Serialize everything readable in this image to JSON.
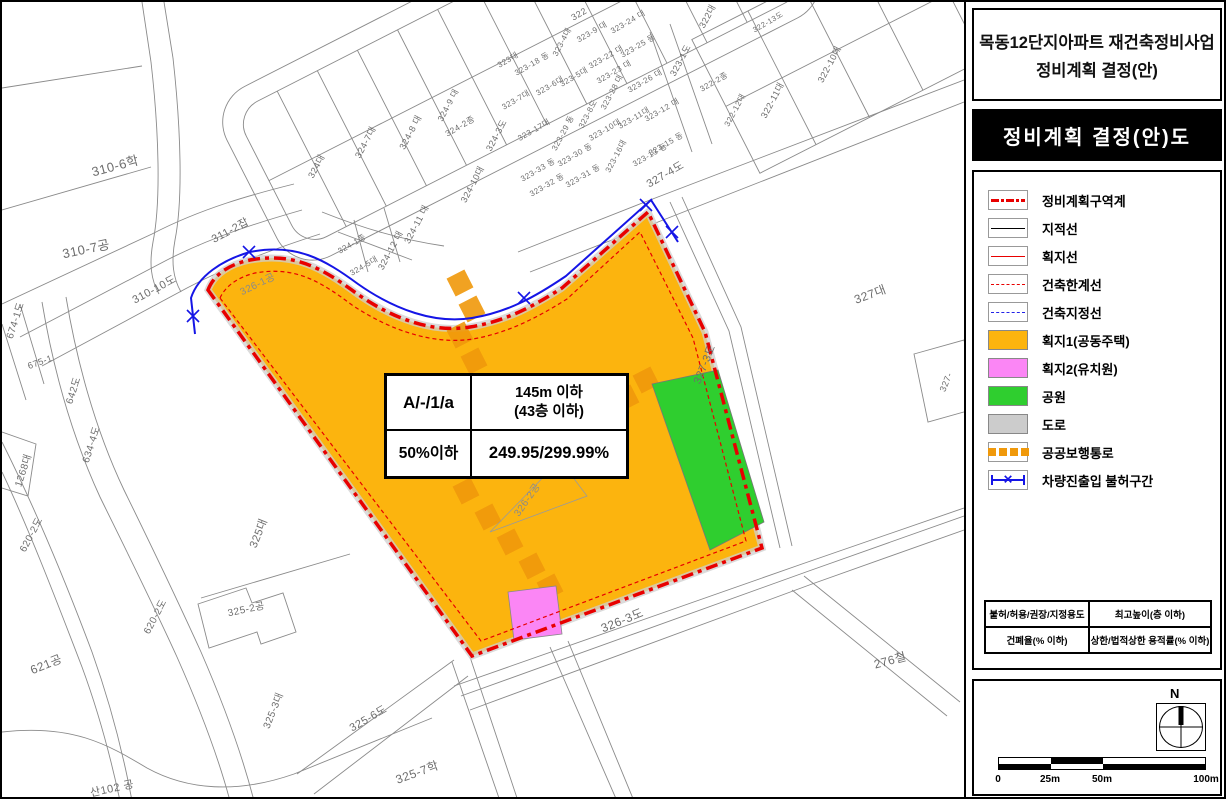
{
  "panel": {
    "title_line1": "목동12단지아파트 재건축정비사업",
    "title_line2": "정비계획 결정(안)",
    "subtitle": "정비계획 결정(안)도",
    "legend": {
      "items": [
        {
          "label": "정비계획구역계",
          "swatch": "red-dash-dot-line"
        },
        {
          "label": "지적선",
          "swatch": "black-line"
        },
        {
          "label": "획지선",
          "swatch": "red-line"
        },
        {
          "label": "건축한계선",
          "swatch": "red-dotted-line"
        },
        {
          "label": "건축지정선",
          "swatch": "blue-dotted-line"
        },
        {
          "label": "획지1(공동주택)",
          "swatch": "orange-fill",
          "color": "#FCB40E"
        },
        {
          "label": "획지2(유치원)",
          "swatch": "pink-fill",
          "color": "#FB86F5"
        },
        {
          "label": "공원",
          "swatch": "green-fill",
          "color": "#2FCE2F"
        },
        {
          "label": "도로",
          "swatch": "gray-fill",
          "color": "#CCCCCC"
        },
        {
          "label": "공공보행통로",
          "swatch": "orange-squares"
        },
        {
          "label": "차량진출입 불허구간",
          "swatch": "blue-x-line"
        }
      ],
      "table": {
        "r1c1": "불허/허용/권장/지정용도",
        "r1c2": "최고높이(층 이하)",
        "r2c1": "건폐율(% 이하)",
        "r2c2": "상한/법적상한 용적률(% 이하)"
      }
    },
    "scale": {
      "north": "N",
      "ticks": [
        "0",
        "25m",
        "50m",
        "100m"
      ]
    }
  },
  "map": {
    "info_table": {
      "zone": "A/-/1/a",
      "height": "145m 이하",
      "height2": "(43층 이하)",
      "coverage": "50%이하",
      "far": "249.95/299.99%"
    },
    "labels": [
      {
        "t": "310-6학",
        "x": 113,
        "y": 163,
        "r": -15,
        "s": 13
      },
      {
        "t": "310-7공",
        "x": 84,
        "y": 246,
        "r": -12,
        "s": 13
      },
      {
        "t": "311-2잡",
        "x": 228,
        "y": 228,
        "r": -28,
        "s": 11
      },
      {
        "t": "310-10도",
        "x": 152,
        "y": 287,
        "r": -28,
        "s": 11
      },
      {
        "t": "674-1도",
        "x": 12,
        "y": 318,
        "r": -72,
        "s": 10
      },
      {
        "t": "675-1",
        "x": 38,
        "y": 360,
        "r": -20,
        "s": 9
      },
      {
        "t": "642도",
        "x": 70,
        "y": 388,
        "r": -72,
        "s": 10
      },
      {
        "t": "634-4도",
        "x": 88,
        "y": 442,
        "r": -72,
        "s": 10
      },
      {
        "t": "1268대",
        "x": 20,
        "y": 468,
        "r": -72,
        "s": 10
      },
      {
        "t": "620-2도",
        "x": 28,
        "y": 532,
        "r": -62,
        "s": 10
      },
      {
        "t": "620-2도",
        "x": 152,
        "y": 614,
        "r": -62,
        "s": 10
      },
      {
        "t": "621공",
        "x": 44,
        "y": 662,
        "r": -22,
        "s": 12
      },
      {
        "t": "산102 공",
        "x": 110,
        "y": 786,
        "r": -12,
        "s": 11
      },
      {
        "t": "325대",
        "x": 256,
        "y": 531,
        "r": -68,
        "s": 11
      },
      {
        "t": "325-2공",
        "x": 244,
        "y": 606,
        "r": -12,
        "s": 10
      },
      {
        "t": "325-3대",
        "x": 270,
        "y": 708,
        "r": -68,
        "s": 10
      },
      {
        "t": "325-6도",
        "x": 366,
        "y": 716,
        "r": -30,
        "s": 11
      },
      {
        "t": "325-7학",
        "x": 415,
        "y": 770,
        "r": -20,
        "s": 12
      },
      {
        "t": "326-1공",
        "x": 255,
        "y": 281,
        "r": -26,
        "s": 10,
        "c": "#8a8a8a"
      },
      {
        "t": "326-2공",
        "x": 524,
        "y": 497,
        "r": -55,
        "s": 10,
        "c": "#8a8a8a"
      },
      {
        "t": "326-3도",
        "x": 620,
        "y": 618,
        "r": -22,
        "s": 12
      },
      {
        "t": "276철",
        "x": 888,
        "y": 658,
        "r": -15,
        "s": 12
      },
      {
        "t": "327대",
        "x": 868,
        "y": 292,
        "r": -20,
        "s": 12
      },
      {
        "t": "327-3도",
        "x": 702,
        "y": 362,
        "r": -68,
        "s": 11
      },
      {
        "t": "327-4도",
        "x": 663,
        "y": 172,
        "r": -30,
        "s": 11
      },
      {
        "t": "327-",
        "x": 944,
        "y": 380,
        "r": -68,
        "s": 9
      },
      {
        "t": "322",
        "x": 577,
        "y": 12,
        "r": -30,
        "s": 9
      },
      {
        "t": "322대",
        "x": 705,
        "y": 14,
        "r": -62,
        "s": 9
      },
      {
        "t": "323-1도",
        "x": 678,
        "y": 58,
        "r": -62,
        "s": 9
      },
      {
        "t": "322-2종",
        "x": 712,
        "y": 80,
        "r": -30,
        "s": 8
      },
      {
        "t": "322-12대",
        "x": 733,
        "y": 108,
        "r": -62,
        "s": 8
      },
      {
        "t": "322-13도",
        "x": 766,
        "y": 20,
        "r": -30,
        "s": 7.5
      },
      {
        "t": "322-10대",
        "x": 827,
        "y": 62,
        "r": -62,
        "s": 9
      },
      {
        "t": "322-11대",
        "x": 770,
        "y": 98,
        "r": -62,
        "s": 9
      },
      {
        "t": "323-9 대",
        "x": 590,
        "y": 30,
        "r": -30,
        "s": 8
      },
      {
        "t": "323-24 대",
        "x": 626,
        "y": 20,
        "r": -30,
        "s": 8
      },
      {
        "t": "323-25 등",
        "x": 636,
        "y": 44,
        "r": -30,
        "s": 8
      },
      {
        "t": "323-22 대",
        "x": 604,
        "y": 55,
        "r": -30,
        "s": 8
      },
      {
        "t": "323-23 대",
        "x": 612,
        "y": 70,
        "r": -30,
        "s": 8
      },
      {
        "t": "323-26 대",
        "x": 643,
        "y": 79,
        "r": -30,
        "s": 8
      },
      {
        "t": "323대",
        "x": 506,
        "y": 58,
        "r": -30,
        "s": 8
      },
      {
        "t": "323-18 동",
        "x": 530,
        "y": 62,
        "r": -30,
        "s": 8
      },
      {
        "t": "323-4대",
        "x": 560,
        "y": 40,
        "r": -62,
        "s": 8
      },
      {
        "t": "323-5대",
        "x": 572,
        "y": 75,
        "r": -30,
        "s": 8
      },
      {
        "t": "323-6대",
        "x": 548,
        "y": 84,
        "r": -30,
        "s": 8
      },
      {
        "t": "323-7대",
        "x": 514,
        "y": 98,
        "r": -30,
        "s": 8
      },
      {
        "t": "323-8도",
        "x": 586,
        "y": 112,
        "r": -62,
        "s": 8
      },
      {
        "t": "323-28 대",
        "x": 610,
        "y": 90,
        "r": -62,
        "s": 8
      },
      {
        "t": "323-17대",
        "x": 532,
        "y": 128,
        "r": -30,
        "s": 8
      },
      {
        "t": "323-29 동",
        "x": 561,
        "y": 131,
        "r": -62,
        "s": 8
      },
      {
        "t": "323-10대",
        "x": 603,
        "y": 128,
        "r": -30,
        "s": 8
      },
      {
        "t": "323-11대",
        "x": 632,
        "y": 116,
        "r": -30,
        "s": 8
      },
      {
        "t": "323-12 대",
        "x": 660,
        "y": 108,
        "r": -30,
        "s": 8
      },
      {
        "t": "323-13 등",
        "x": 648,
        "y": 153,
        "r": -30,
        "s": 8
      },
      {
        "t": "323-15 동",
        "x": 664,
        "y": 142,
        "r": -30,
        "s": 8
      },
      {
        "t": "323-16대",
        "x": 614,
        "y": 154,
        "r": -62,
        "s": 8
      },
      {
        "t": "323-30 동",
        "x": 573,
        "y": 153,
        "r": -30,
        "s": 8
      },
      {
        "t": "323-31 동",
        "x": 581,
        "y": 174,
        "r": -30,
        "s": 8
      },
      {
        "t": "323-32 동",
        "x": 545,
        "y": 183,
        "r": -30,
        "s": 8
      },
      {
        "t": "323-33 동",
        "x": 536,
        "y": 168,
        "r": -30,
        "s": 8
      },
      {
        "t": "324대",
        "x": 314,
        "y": 164,
        "r": -62,
        "s": 9
      },
      {
        "t": "324-7대",
        "x": 363,
        "y": 140,
        "r": -62,
        "s": 9
      },
      {
        "t": "324-8 대",
        "x": 408,
        "y": 130,
        "r": -62,
        "s": 9
      },
      {
        "t": "324-9 대",
        "x": 446,
        "y": 103,
        "r": -62,
        "s": 8.5
      },
      {
        "t": "324-2종",
        "x": 458,
        "y": 124,
        "r": -30,
        "s": 8.5
      },
      {
        "t": "324-3도",
        "x": 494,
        "y": 133,
        "r": -62,
        "s": 9
      },
      {
        "t": "324-10대",
        "x": 470,
        "y": 182,
        "r": -62,
        "s": 9
      },
      {
        "t": "324-11 대",
        "x": 414,
        "y": 222,
        "r": -62,
        "s": 9
      },
      {
        "t": "324-12 대",
        "x": 388,
        "y": 248,
        "r": -62,
        "s": 9
      },
      {
        "t": "324-1종",
        "x": 350,
        "y": 242,
        "r": -30,
        "s": 8
      },
      {
        "t": "324-5대",
        "x": 362,
        "y": 264,
        "r": -30,
        "s": 8
      }
    ]
  },
  "colors": {
    "boundary_red": "#E80000",
    "access_blue": "#1515E6",
    "parcel1_orange": "#FCB40E",
    "parcel2_pink": "#FB86F5",
    "park_green": "#2FCE2F",
    "road_gray": "#CCCCCC",
    "walkway_orange": "#F0990B",
    "cadastral_gray": "#8A8A8A"
  }
}
